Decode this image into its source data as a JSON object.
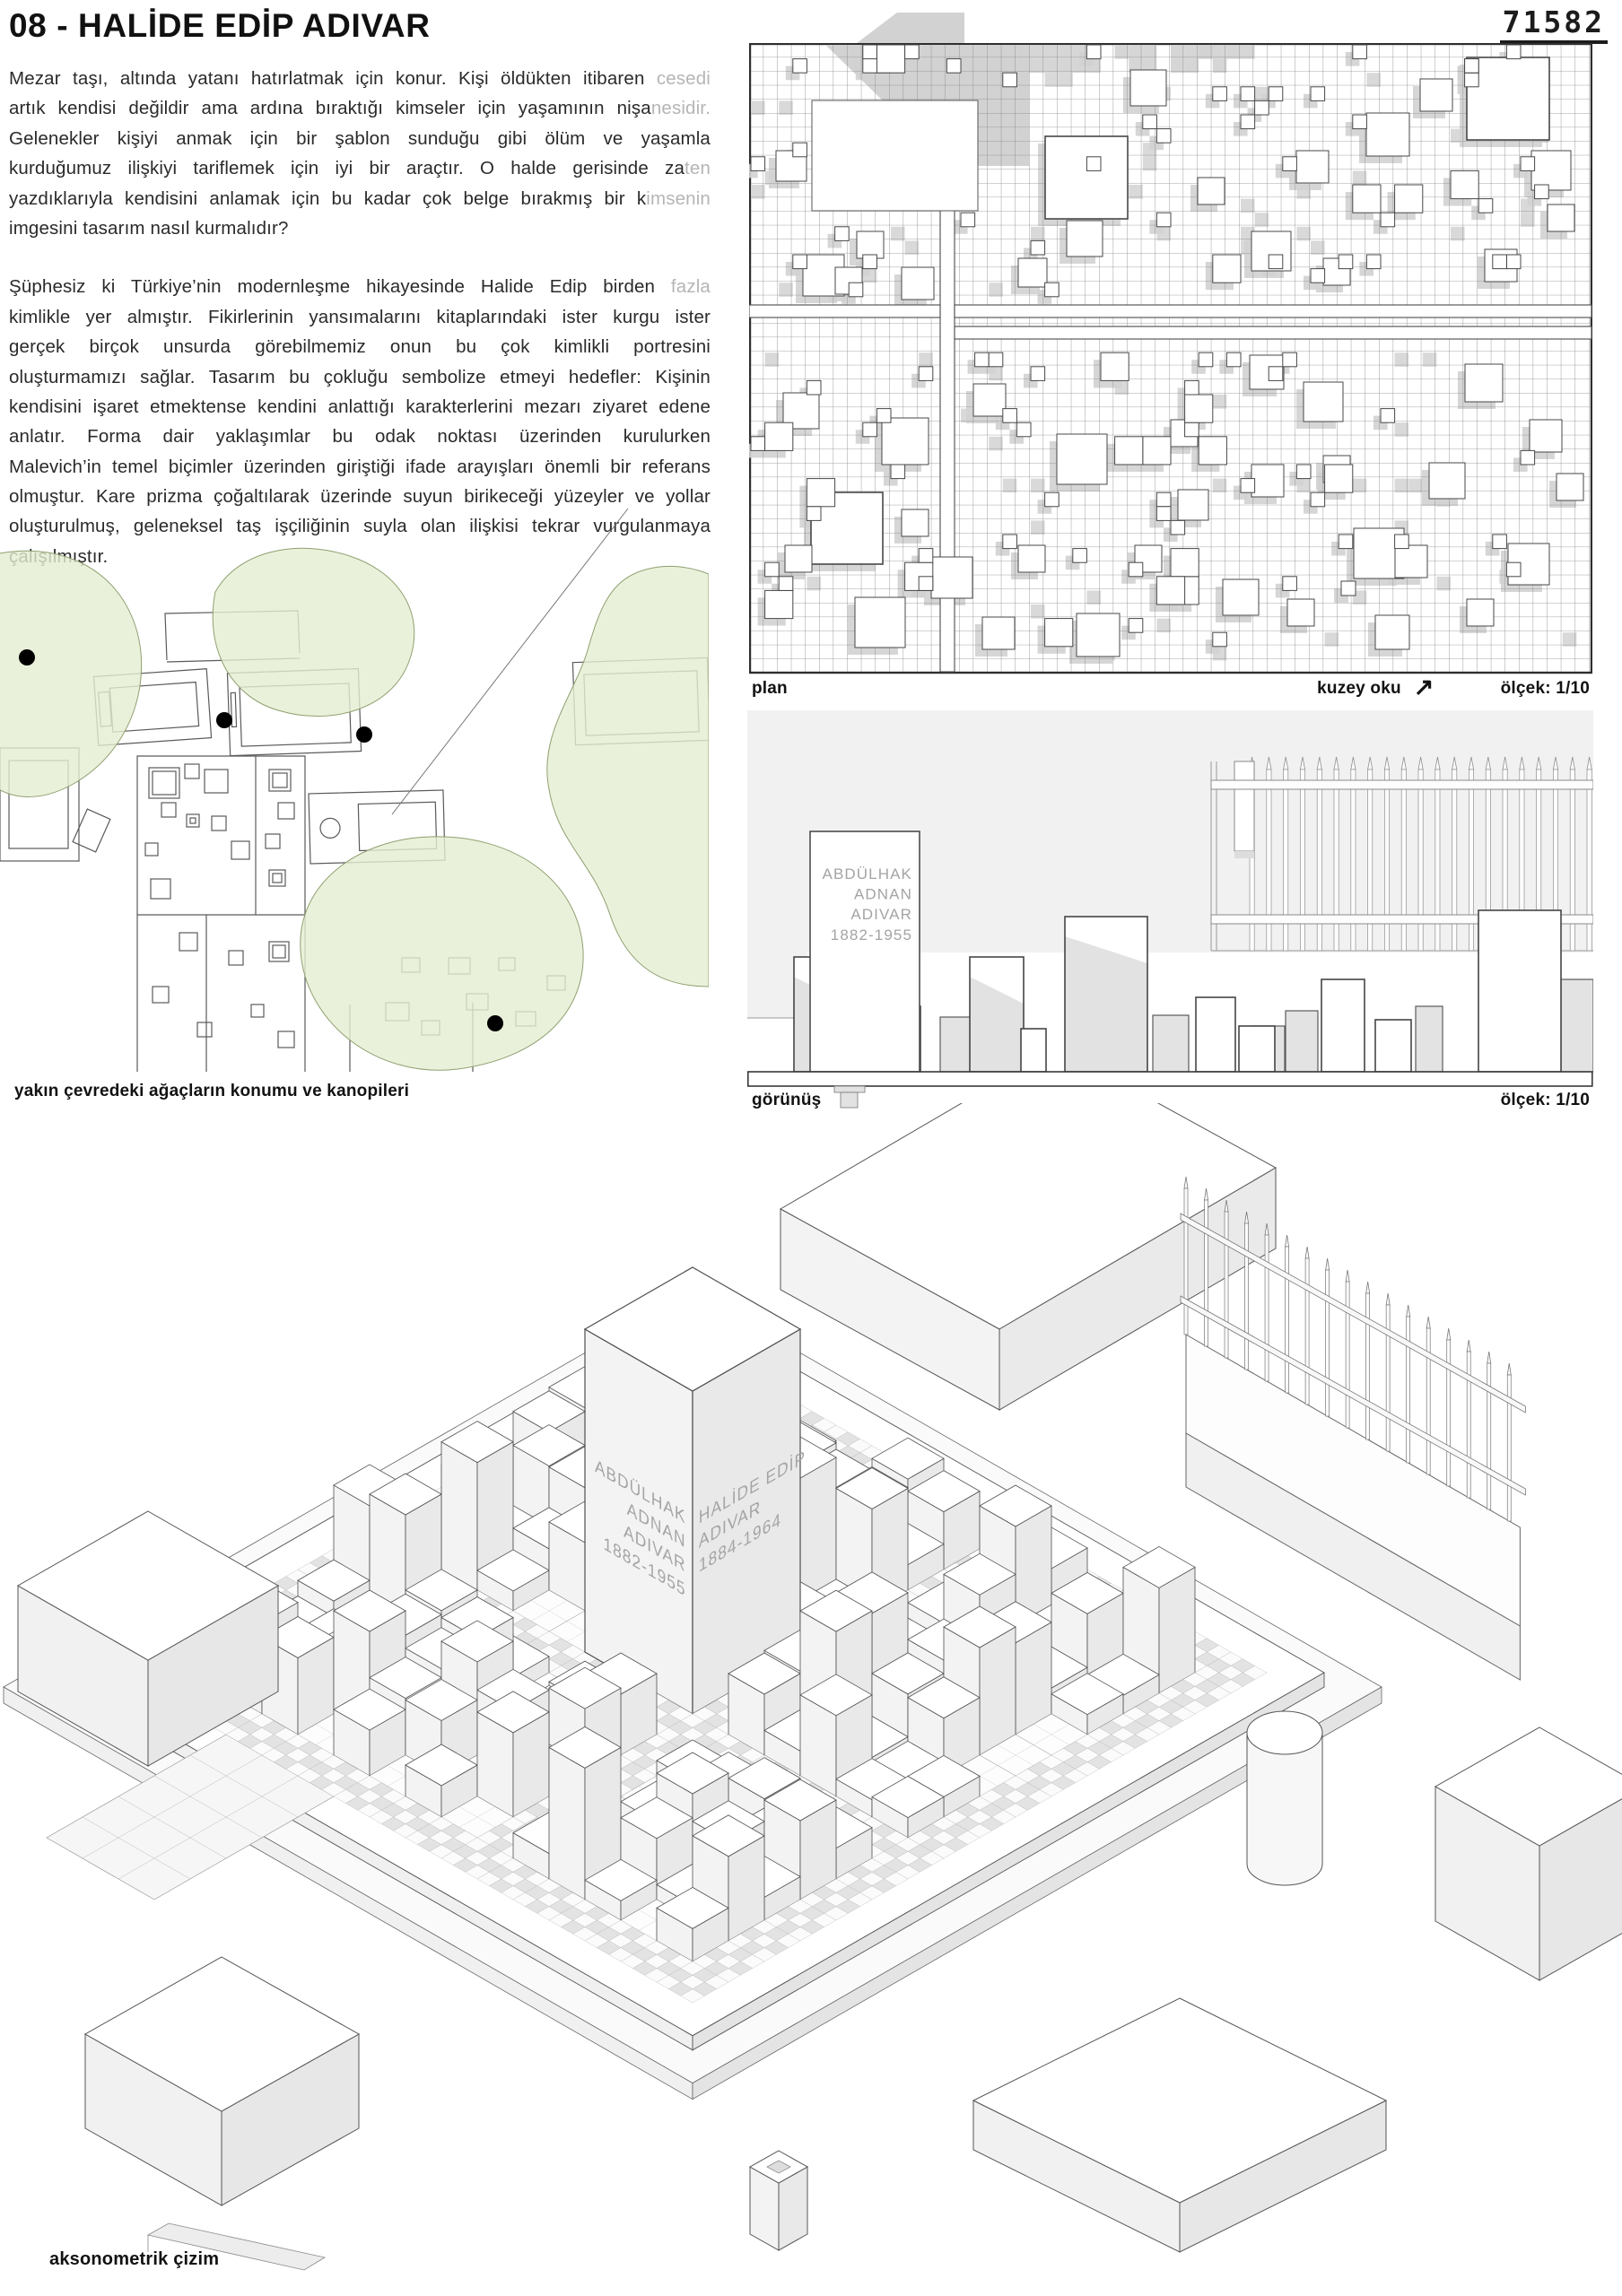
{
  "header": {
    "title": "08 - HALİDE EDİP ADIVAR",
    "entry_number": "71582"
  },
  "intro": {
    "paragraph1": [
      {
        "black": "Mezar taşı, altında yatanı hatırlatmak için konur. Kişi öldükten itibaren",
        "grey": " cesedi"
      },
      {
        "black": "artık kendisi değildir ama ardına bıraktığı kimseler için yaşamının nişa",
        "grey": "nesidir."
      },
      {
        "black": "Gelenekler kişiyi anmak için bir şablon sunduğu gibi ölüm ve yaşamla",
        "grey": ""
      },
      {
        "black": "kurduğumuz ilişkiyi tariflemek için iyi bir araçtır. O halde gerisinde za",
        "grey": "ten"
      },
      {
        "black": "yazdıklarıyla kendisini anlamak için bu kadar çok belge bırakmış bir k",
        "grey": "imsenin"
      },
      {
        "black": "imgesini tasarım nasıl kurmalıdır?",
        "grey": ""
      }
    ],
    "paragraph2": [
      {
        "black": "Şüphesiz ki Türkiye’nin modernleşme hikayesinde Halide Edip birden",
        "grey": " fazla"
      },
      {
        "black": "kimlikle yer almıştır. Fikirlerinin yansımalarını kitaplarındaki ister kurgu ister",
        "grey": ""
      },
      {
        "black": "gerçek birçok unsurda görebilmemiz onun bu çok kimlikli portresini",
        "grey": ""
      },
      {
        "black": "oluşturmamızı sağlar. Tasarım bu çokluğu sembolize etmeyi hedefler: Kişinin",
        "grey": ""
      },
      {
        "black": "kendisini işaret etmektense kendini anlattığı karakterlerini mezarı ziyaret edene",
        "grey": ""
      },
      {
        "black": "anlatır. Forma dair yaklaşımlar bu odak noktası üzerinden kurulurken",
        "grey": ""
      },
      {
        "black": "Malevich’in temel biçimler üzerinden giriştiği ifade arayışları önemli bir referans",
        "grey": ""
      },
      {
        "black": "olmuştur. Kare prizma çoğaltılarak üzerinde suyun birikeceği yüzeyler ve yollar",
        "grey": ""
      },
      {
        "black": "oluşturulmuş, geleneksel taş işçiliğinin suyla olan ilişkisi tekrar vurgulanmaya",
        "grey": ""
      },
      {
        "black": "çalışılmıştır.",
        "grey": ""
      }
    ]
  },
  "plan": {
    "label": "plan",
    "north_label": "kuzey oku",
    "north_arrow_icon": "arrow-up-right",
    "scale_label": "ölçek: 1/10"
  },
  "site_plan": {
    "caption": "yakın çevredeki ağaçların konumu ve kanopileri"
  },
  "elevation": {
    "label": "görünüş",
    "scale_label": "ölçek: 1/10",
    "stone_inscription": [
      "ABDÜLHAK",
      "ADNAN",
      "ADIVAR",
      "1882-1955"
    ]
  },
  "axonometric": {
    "caption": "aksonometrik çizim",
    "monument_left_face": [
      "ABDÜLHAK",
      "ADNAN",
      "ADIVAR",
      "1882-1955"
    ],
    "monument_right_face": [
      "HALİDE EDİP",
      "ADIVAR",
      "1884-1964"
    ]
  },
  "colors": {
    "canopy": "#e5eed2",
    "canopy_stroke": "#8fa06f",
    "shadow": "#d2d2d2",
    "line": "#4a4a4a",
    "inscription": "#a4a4a4",
    "background_grey": "#f1f1f1"
  }
}
